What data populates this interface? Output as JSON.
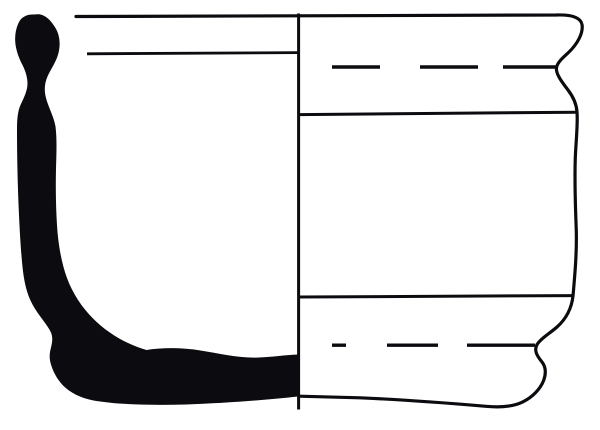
{
  "figure": {
    "type": "archaeological-vessel-profile",
    "view_left": "cross-section (solid fill)",
    "view_right": "exterior elevation",
    "canvas": {
      "width": 600,
      "height": 430
    },
    "colors": {
      "background": "#ffffff",
      "ink": "#0c0c10"
    },
    "section_profile": {
      "type": "filled-path",
      "fill": "#0c0c10",
      "path": "M 34 14.5 C 27 14 21 17 18.5 23 C 15.5 29.5 14.5 37 15.5 44.5 C 16.5 51 18.5 57.5 22.5 65 C 25.5 71 27.5 77.5 27.5 83.5 C 27.5 90.5 24 97.5 20.5 105 C 17.5 112 17 120 17 131 C 17 154 17.5 179 18.5 204 C 19.5 227 20.5 247 22.5 267 C 24 281 26.5 293.5 32.5 304.5 C 38.5 315.5 46.5 323.5 50.5 331.5 C 53 336.5 52.5 341.5 51 347.5 C 49.5 353 49 358.5 51 364.5 C 53 371.5 57 379 63 385.5 C 70 392.5 80.5 398 93.5 400.5 C 116 404.5 151 405.5 186 404.5 C 226 403 266 400 298 396.5 L 298 354.5 C 285 355 272.5 357 258.5 357.5 C 240 358.5 220 353.5 200.5 350.5 C 182 347.5 162.5 347.5 146.5 350 C 128.5 345 108.5 334 93.5 319 C 81.5 307 72.5 293 67 278 C 62 264.5 59 248.5 57.5 232 C 56 212.5 55.5 190.5 56 168.5 C 56.5 152.5 57 138.5 55.5 126.5 C 54 117 48.5 107.5 46 98 C 44 90 44.5 83.5 47.5 76.5 C 50.5 69.5 56.5 61.5 58.5 53 C 60.5 44.5 60 35.5 55.5 28 C 51.5 21.5 47 16 40.5 14.5 C 38.5 14 36 14.3 34 14.5 Z"
    },
    "exterior_outline": {
      "type": "stroked-path",
      "stroke_width": 3.2,
      "path": "M 76 16.5 L 556 15 C 570 14.5 580.5 16.5 582 24.5 C 583.5 33 577.5 44 568 53 C 562 58.5 557.5 62.5 556.5 67.5 C 555.5 73.5 561.5 81.5 568 90 C 573 96.5 576.5 104.5 577 112 C 578 124 576 140 575.3 158 C 574.5 182 575.3 205 576.2 228 C 577 251 575 273.5 573 296 C 571.5 309 566 319 557 327 C 549 334 540 339 536.8 345 C 533.8 351 537.5 356.5 542 362 C 545.5 366.5 546.2 373 543.8 380 C 540.5 389 532.5 397 523 401.8 C 513 406.8 500 407.6 486 406.3 C 445 402.8 400 399.5 360 397.8 L 299 396.2"
    },
    "centerline": {
      "type": "line",
      "x1": 298.6,
      "y1": 13.5,
      "x2": 298.6,
      "y2": 409.5,
      "stroke_width": 3
    },
    "lines": {
      "rim_interior": {
        "type": "line",
        "x1": 87,
        "y1": 53.8,
        "x2": 298,
        "y2": 52.6,
        "stroke_width": 2.8
      },
      "shoulder": {
        "type": "line",
        "x1": 299,
        "y1": 114.6,
        "x2": 577,
        "y2": 112.2,
        "stroke_width": 3
      },
      "lower_body": {
        "type": "line",
        "x1": 299,
        "y1": 297,
        "x2": 573,
        "y2": 295.6,
        "stroke_width": 3
      }
    },
    "dashed": {
      "upper": {
        "type": "dash-set",
        "y": 67,
        "stroke_width": 3.4,
        "segments": [
          [
            332,
            380
          ],
          [
            420,
            478
          ],
          [
            503,
            556
          ]
        ]
      },
      "lower": {
        "type": "dash-set",
        "y": 345.2,
        "stroke_width": 3.4,
        "segments": [
          [
            332,
            346
          ],
          [
            387,
            438
          ],
          [
            467,
            535
          ]
        ]
      }
    }
  }
}
